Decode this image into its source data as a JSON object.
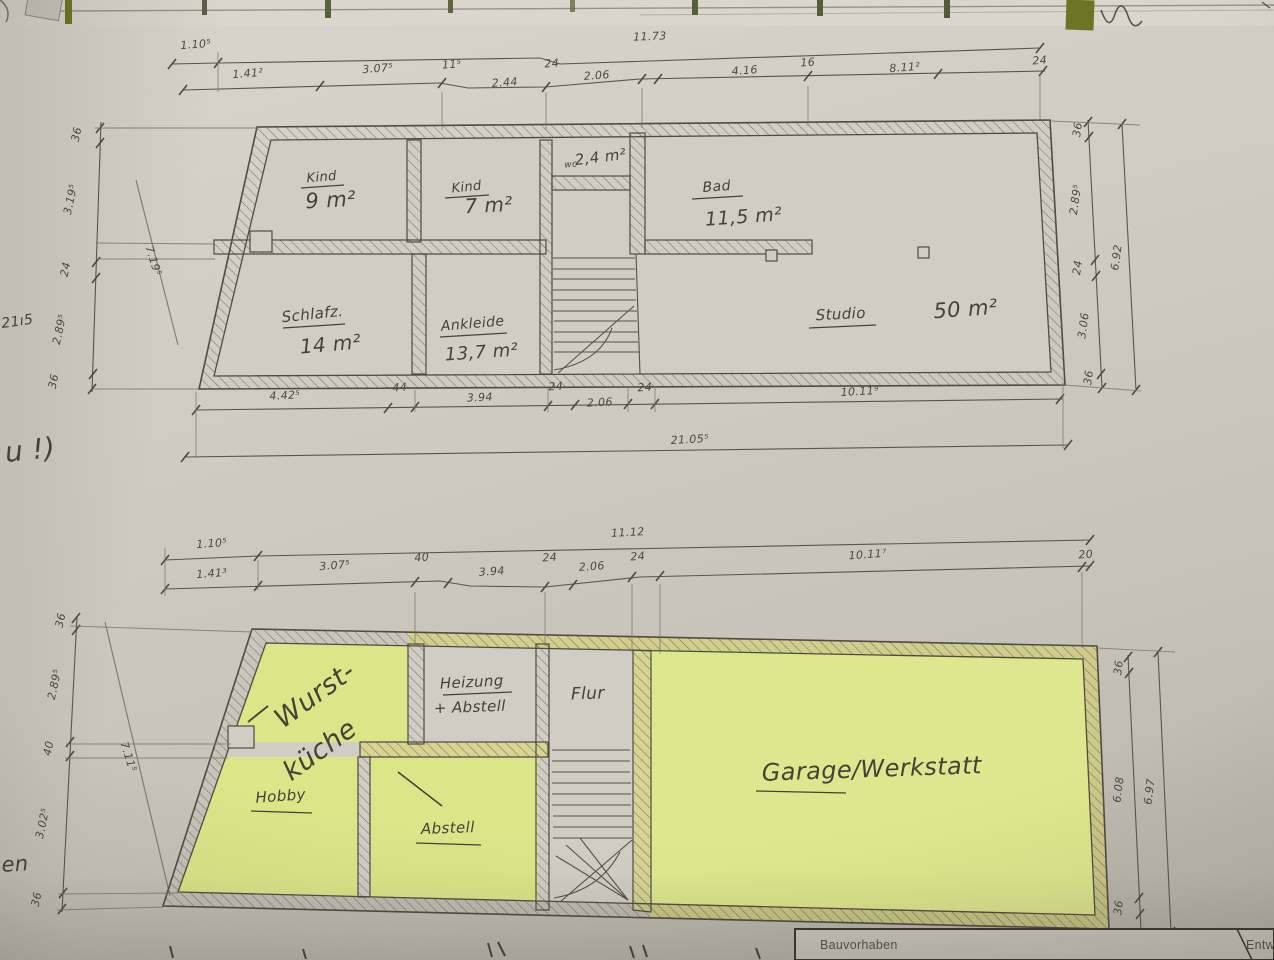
{
  "photo": {
    "colors": {
      "paper": "#d0cbc2",
      "highlight_yellow": "#dde588",
      "olive_green": "#6d7424",
      "pencil": "#55504a",
      "ink": "#46413a"
    }
  },
  "upper_plan": {
    "rooms": [
      {
        "name": "Kind",
        "area": "9 m²"
      },
      {
        "name": "Kind",
        "area": "7 m²"
      },
      {
        "name": "wc",
        "area": "2,4 m²"
      },
      {
        "name": "Bad",
        "area": "11,5 m²"
      },
      {
        "name": "Schlafz.",
        "area": "14 m²"
      },
      {
        "name": "Ankleide",
        "area": "13,7 m²"
      },
      {
        "name": "Studio",
        "area": "50 m²"
      }
    ],
    "dims": {
      "top_left": "1.10⁵",
      "top_total": "11.73",
      "top_segments": [
        "1.41²",
        "3.07⁵",
        "11⁵",
        "2.44",
        "24",
        "2.06",
        "4.16",
        "16",
        "8.11²",
        "24"
      ],
      "bottom_segments": [
        "4.42⁵",
        "44",
        "3.94",
        "24",
        "2.06",
        "24",
        "10.11⁹"
      ],
      "bottom_total": "21.05⁵",
      "left_segments": [
        "36",
        "3.19⁵",
        "24",
        "2.89⁵",
        "36"
      ],
      "left_diagonal": "7.19⁵",
      "right_segments": [
        "36",
        "2.89⁵",
        "24",
        "3.06",
        "36"
      ],
      "right_total": "6.92"
    }
  },
  "lower_plan": {
    "rooms": [
      {
        "name": "Wurst-",
        "name2": "küche"
      },
      {
        "name": "Heizung",
        "name2": "+ Abstell"
      },
      {
        "name": "Flur"
      },
      {
        "name": "Garage/Werkstatt"
      },
      {
        "name": "Hobby"
      },
      {
        "name": "Abstell"
      }
    ],
    "dims": {
      "top_left": "1.10⁵",
      "top_total": "11.12",
      "top_segments": [
        "1.41³",
        "3.07⁵",
        "40",
        "3.94",
        "24",
        "2.06",
        "24",
        "10.11⁷",
        "20"
      ],
      "left_segments": [
        "36",
        "2.89⁵",
        "40",
        "3.02⁵",
        "36"
      ],
      "left_diagonal": "7.11⁵",
      "right_segments": [
        "36",
        "6.08",
        "36"
      ],
      "right_total": "6.97"
    }
  },
  "title_block": {
    "bauvorhaben": "Bauvorhaben",
    "entwurf": "Entwurfsv"
  },
  "margin_notes": {
    "left_upper": "21ı5",
    "left_mid": "u !)",
    "left_lower": "en"
  }
}
